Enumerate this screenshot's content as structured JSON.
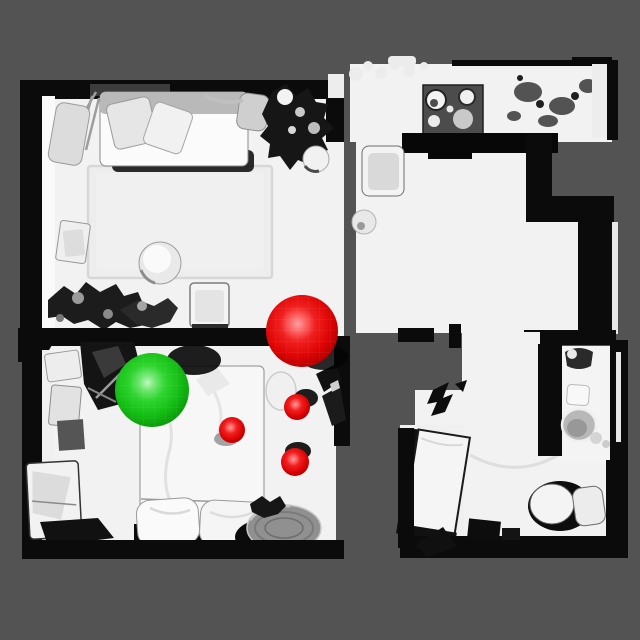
{
  "scene": {
    "kind": "top-down-3d-scan-render",
    "colors": {
      "background": "#535353",
      "floor": "#f2f2f2",
      "wall": "#0b0b0b",
      "marker_red": "#e81010",
      "marker_green": "#1ecc1e"
    }
  },
  "markers": [
    {
      "id": "red-large",
      "color": "red",
      "cx": 302,
      "cy": 331,
      "r": 36,
      "shadow": {
        "dx": 22,
        "dy": 26,
        "rx": 24,
        "ry": 13,
        "opacity": 0.85
      }
    },
    {
      "id": "green-large",
      "color": "green",
      "cx": 152,
      "cy": 390,
      "r": 37,
      "shadow": {
        "dx": 42,
        "dy": -30,
        "rx": 27,
        "ry": 15,
        "opacity": 0.9
      }
    },
    {
      "id": "red-small-bed",
      "color": "red",
      "cx": 232,
      "cy": 430,
      "r": 13,
      "shadow": {
        "dx": -6,
        "dy": 9,
        "rx": 12,
        "ry": 7,
        "opacity": 0.35
      }
    },
    {
      "id": "red-small-floor-upper",
      "color": "red",
      "cx": 297,
      "cy": 407,
      "r": 13,
      "shadow": {
        "dx": 9,
        "dy": -9,
        "rx": 12,
        "ry": 9,
        "opacity": 0.9
      }
    },
    {
      "id": "red-small-floor-lower",
      "color": "red",
      "cx": 295,
      "cy": 462,
      "r": 14,
      "shadow": {
        "dx": 3,
        "dy": -11,
        "rx": 13,
        "ry": 9,
        "opacity": 0.9
      }
    }
  ]
}
